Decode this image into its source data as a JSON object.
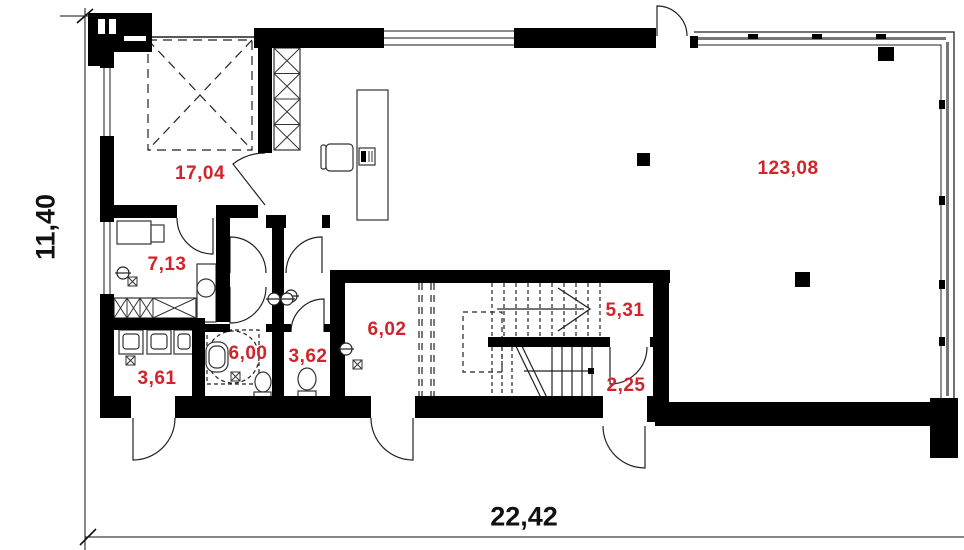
{
  "plan": {
    "dimensions": {
      "horizontal": "22,42",
      "vertical": "11,40"
    },
    "rooms": [
      {
        "id": "room-1",
        "area": "17,04"
      },
      {
        "id": "room-2",
        "area": "7,13"
      },
      {
        "id": "room-3",
        "area": "3,61"
      },
      {
        "id": "room-4",
        "area": "6,00"
      },
      {
        "id": "room-5",
        "area": "3,62"
      },
      {
        "id": "room-6",
        "area": "6,02"
      },
      {
        "id": "room-7",
        "area": "5,31"
      },
      {
        "id": "room-8",
        "area": "2,25"
      },
      {
        "id": "room-9",
        "area": "123,08"
      }
    ],
    "colors": {
      "area_label": "#d2232a",
      "dimension_label": "#111111",
      "wall": "#000000",
      "background": "#ffffff"
    }
  }
}
